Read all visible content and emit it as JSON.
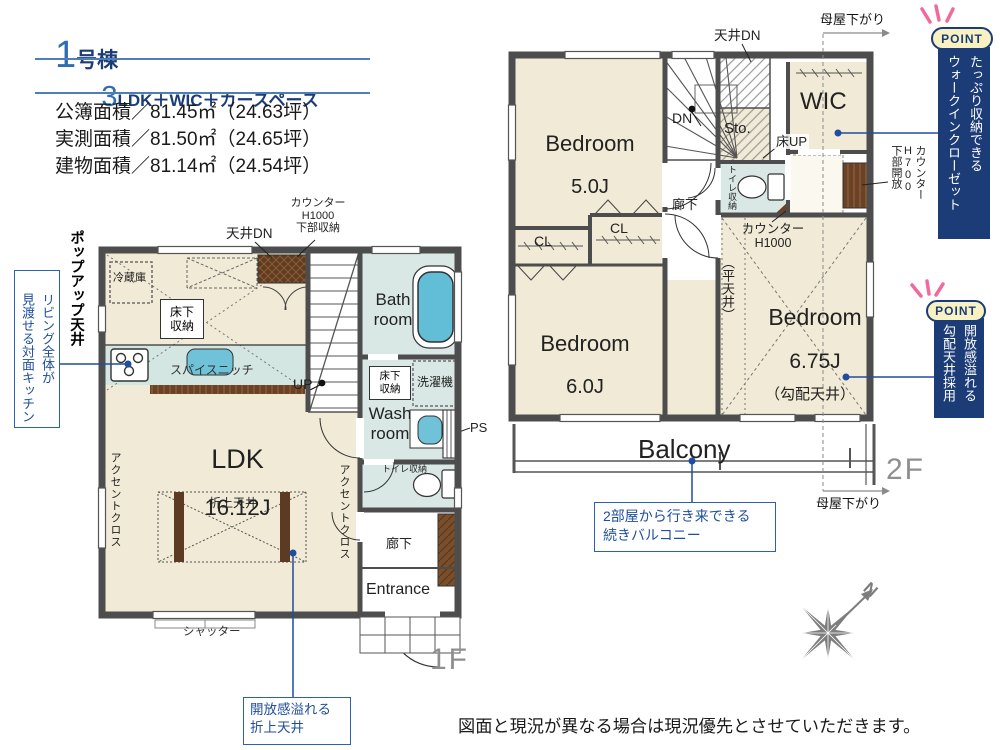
{
  "header": {
    "unit_no": "1",
    "unit_suffix": "号棟",
    "plan_no": "3",
    "plan_suffix": "LDK＋WIC＋カースペース",
    "area_lines": [
      "公簿面積／81.45㎡（24.63坪）",
      "実測面積／81.50㎡（24.65坪）",
      "建物面積／81.14㎡（24.54坪）"
    ]
  },
  "floor1": {
    "floor_label": "1F",
    "ldk": "LDK",
    "ldk_size": "16.12J",
    "bath": "Bath\nroom",
    "wash": "Wash\nroom",
    "entrance": "Entrance",
    "hallway": "廊下",
    "fridge": "冷蔵庫",
    "underfloor_kitchen": "床下\n収納",
    "underfloor_wash": "床下\n収納",
    "spice_niche": "スパイスニッチ",
    "ceiling_dn": "天井DN",
    "counter_note": "カウンター\nH1000\n下部収納",
    "up": "UP",
    "washer": "洗濯機",
    "ps": "PS",
    "toilet_storage": "トイレ収納",
    "coffered": "折上天井",
    "accent_left": "アクセントクロス",
    "accent_right": "アクセントクロス",
    "shutter": "シャッター",
    "popup_ceiling": "ポップアップ天井"
  },
  "floor2": {
    "floor_label": "2F",
    "bedroom1": "Bedroom",
    "bedroom1_size": "5.0J",
    "bedroom2": "Bedroom",
    "bedroom2_size": "6.0J",
    "bedroom3": "Bedroom",
    "bedroom3_size": "6.75J",
    "wic": "WIC",
    "storage": "Sto.",
    "dn": "DN",
    "ceiling_dn": "天井DN",
    "floor_up": "床UP",
    "hallway": "廊下",
    "toilet_storage": "トイレ収納",
    "cl1": "CL",
    "cl2": "CL",
    "counter_h1000": "カウンター\nH1000",
    "counter_h700": "カウンター\nH700\n下部開放",
    "flat_ceiling": "（平天井）",
    "sloped_ceiling": "（勾配天井）",
    "balcony": "Balcony",
    "moya_top": "母屋下がり",
    "moya_bottom": "母屋下がり"
  },
  "annotations": {
    "point_badge1": "POINT",
    "point_badge2": "POINT",
    "point1_text": "たっぷり収納できる\nウォークインクローゼット",
    "point2_text": "開放感溢れる\n勾配天井採用",
    "kitchen_callout": "リビング全体が\n見渡せる対面キッチン",
    "ldk_callout": "開放感溢れる\n折上天井",
    "balcony_callout": "2部屋から行き来できる\n続きバルコニー",
    "compass_n": "N",
    "disclaimer": "図面と現況が異なる場合は現況優先とさせていただきます。"
  },
  "colors": {
    "navy": "#1b3c78",
    "blue": "#2e6db4",
    "callout_blue": "#2a62ae",
    "wall": "#4d4d4d",
    "room_cream": "#f0ead6",
    "wet_blue": "#d9e8e4",
    "water_blue": "#66bfd6",
    "counter_brown": "#6b4226",
    "spark_pink": "#f06a9d",
    "point_bg": "#f8f2c2",
    "gray_label": "#8f8f8f"
  }
}
